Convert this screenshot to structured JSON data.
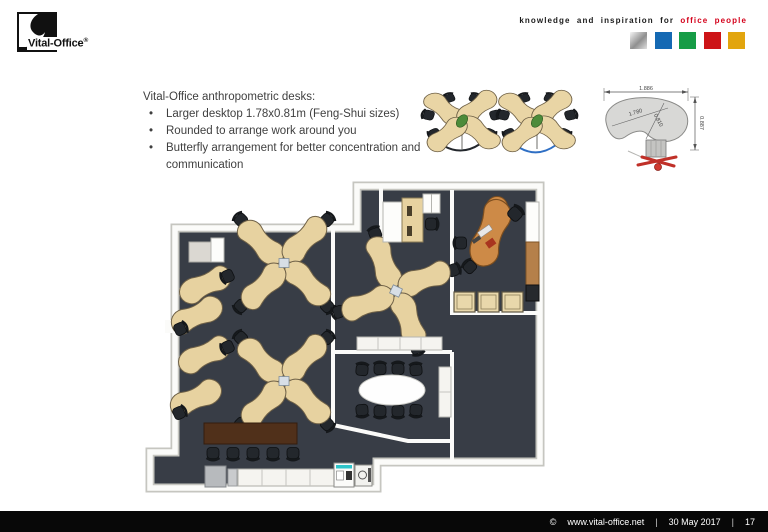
{
  "header": {
    "logo_text": "Vital-Office",
    "logo_registered": "®",
    "tagline_black": "knowledge and inspiration for",
    "tagline_red": "office people",
    "tagline_red_color": "#d4001a",
    "palette": [
      "#c0c0c0",
      "#1569b3",
      "#169c46",
      "#cd1417",
      "#e2a50e"
    ]
  },
  "content": {
    "title": "Vital-Office anthropometric desks:",
    "bullets": [
      "Larger desktop 1.78x0.81m (Feng-Shui sizes)",
      "Rounded to arrange work around you",
      "Butterfly arrangement for better concentration and communication"
    ]
  },
  "drawing": {
    "overall_width": "1.886",
    "overall_depth": "0.887",
    "desktop_width": "1.780",
    "desktop_depth": "0.810"
  },
  "floorplan": {
    "floor_color": "#383d46",
    "desk_color": "#e7d2a0",
    "exec_desk_color": "#cd8a47",
    "wall_color": "#fbfbf9"
  },
  "footer": {
    "copyright_symbol": "©",
    "url": "www.vital-office.net",
    "separator": "|",
    "date": "30 May 2017",
    "page": "17"
  }
}
